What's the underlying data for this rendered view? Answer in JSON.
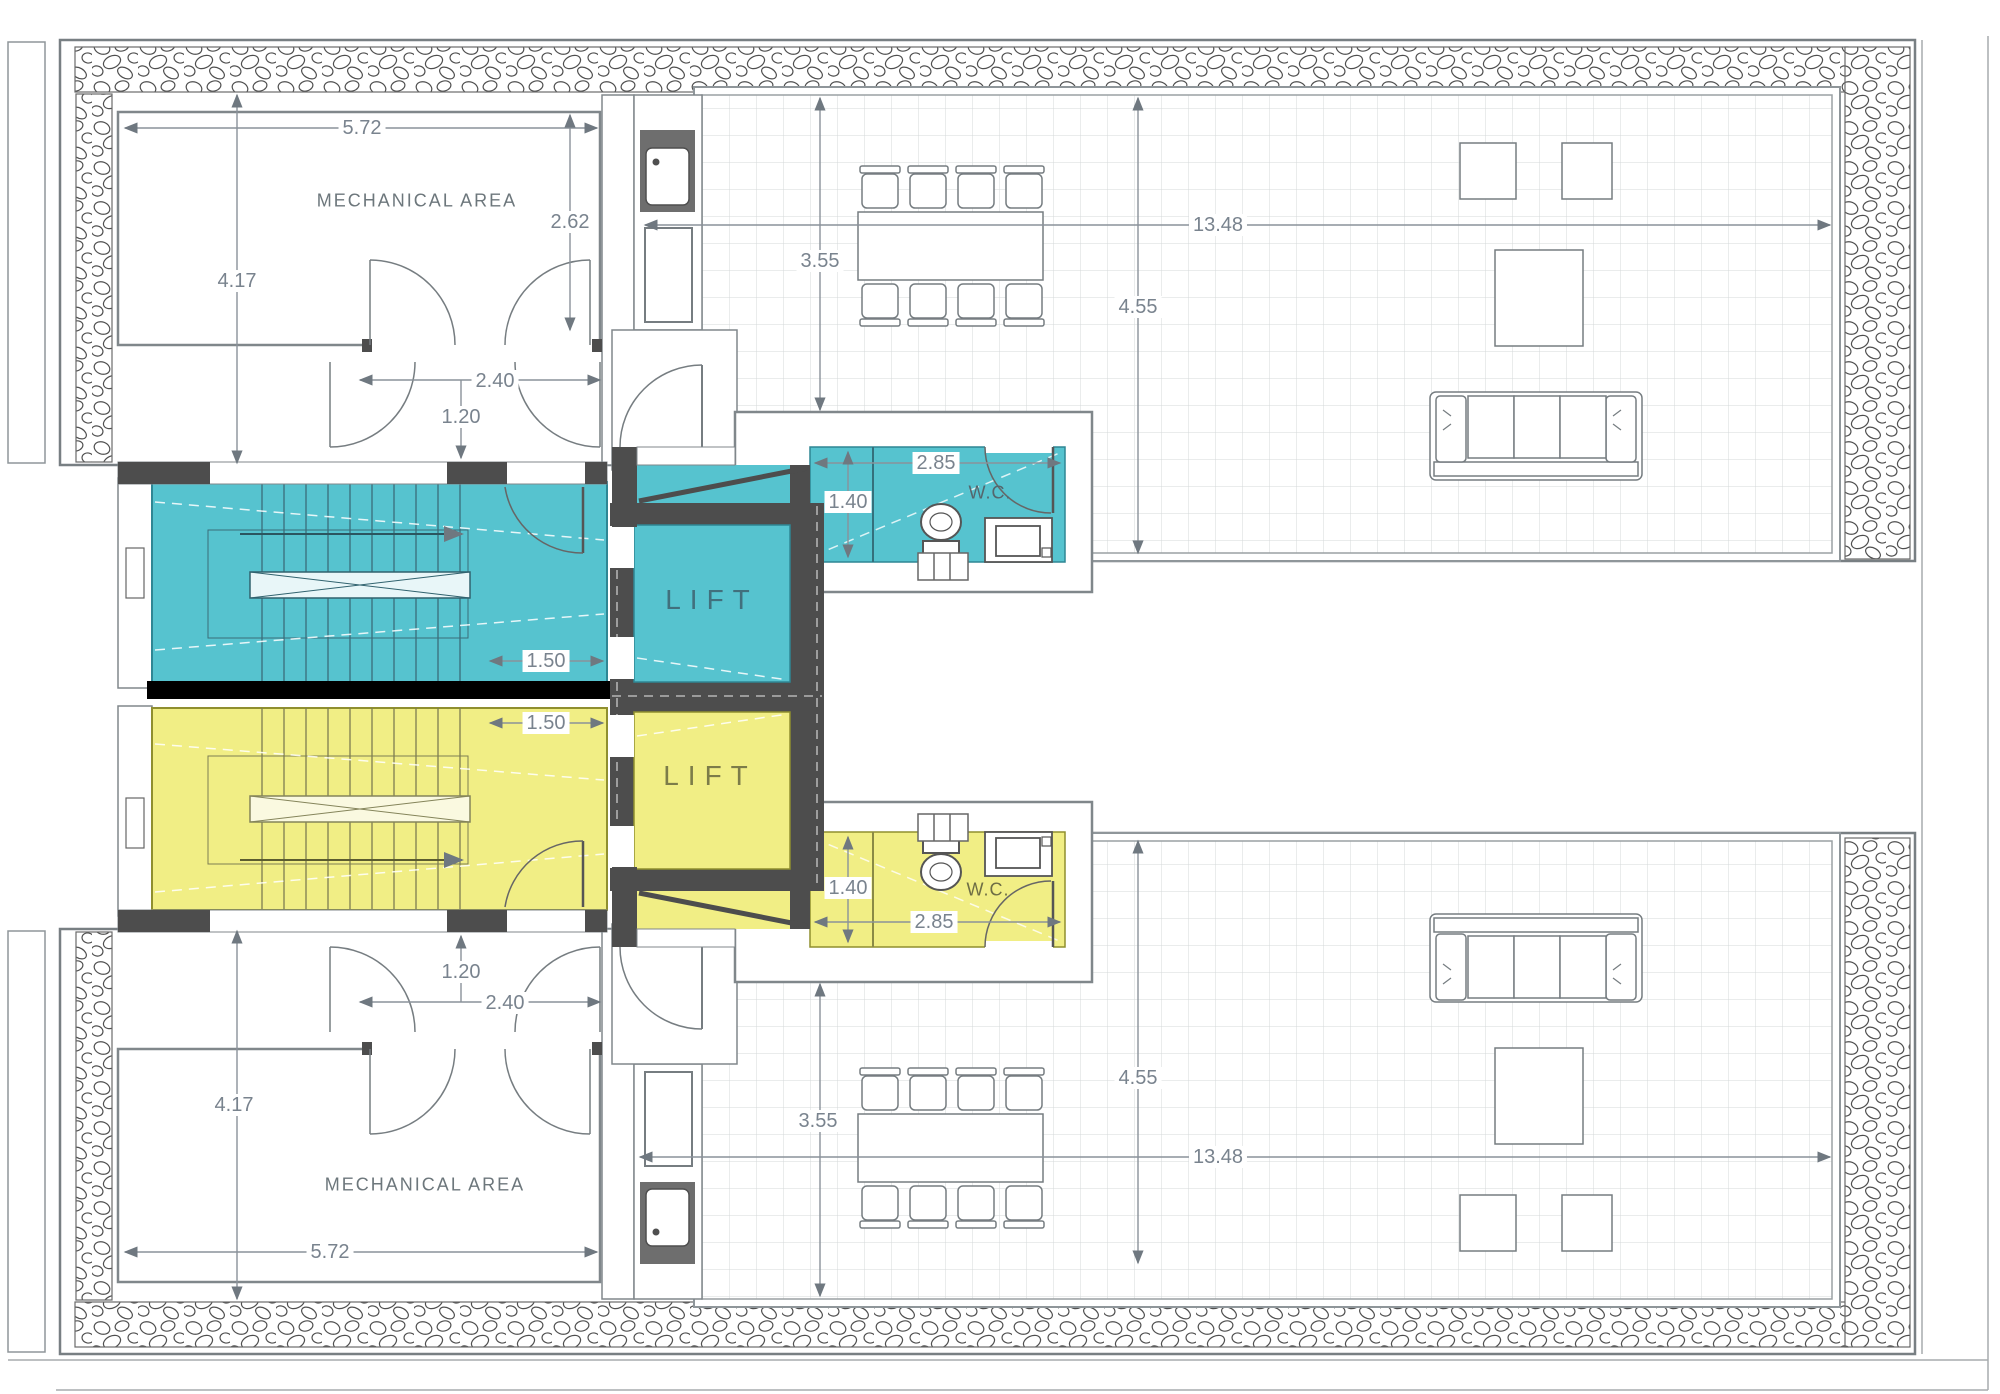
{
  "drawing": {
    "type": "architectural-floor-plan",
    "rooms": {
      "mechanical_area_top": "MECHANICAL AREA",
      "mechanical_area_bottom": "MECHANICAL AREA",
      "lift_top": "LIFT",
      "lift_bottom": "LIFT",
      "wc_top": "W.C.",
      "wc_bottom": "W.C."
    },
    "dimensions_top": {
      "mech_width": "5.72",
      "mech_height": "4.17",
      "mech_depth": "2.62",
      "door_width": "2.40",
      "door_leaf": "1.20",
      "stair_width": "1.50",
      "wc_width": "2.85",
      "wc_depth": "1.40",
      "terrace_front_depth": "3.55",
      "terrace_depth": "4.55",
      "terrace_width": "13.48"
    },
    "dimensions_bottom": {
      "mech_width": "5.72",
      "mech_height": "4.17",
      "door_width": "2.40",
      "door_leaf": "1.20",
      "stair_width": "1.50",
      "wc_width": "2.85",
      "wc_depth": "1.40",
      "terrace_front_depth": "3.55",
      "terrace_depth": "4.55",
      "terrace_width": "13.48"
    },
    "colors": {
      "unit_a_accent": "#56c3cf",
      "unit_b_accent": "#f1ee85",
      "wall_dark": "#4d4d4d",
      "separator": "#000000",
      "line_gray": "#80878b",
      "dim_text": "#79838e",
      "tile_line": "#d4d8da"
    }
  }
}
